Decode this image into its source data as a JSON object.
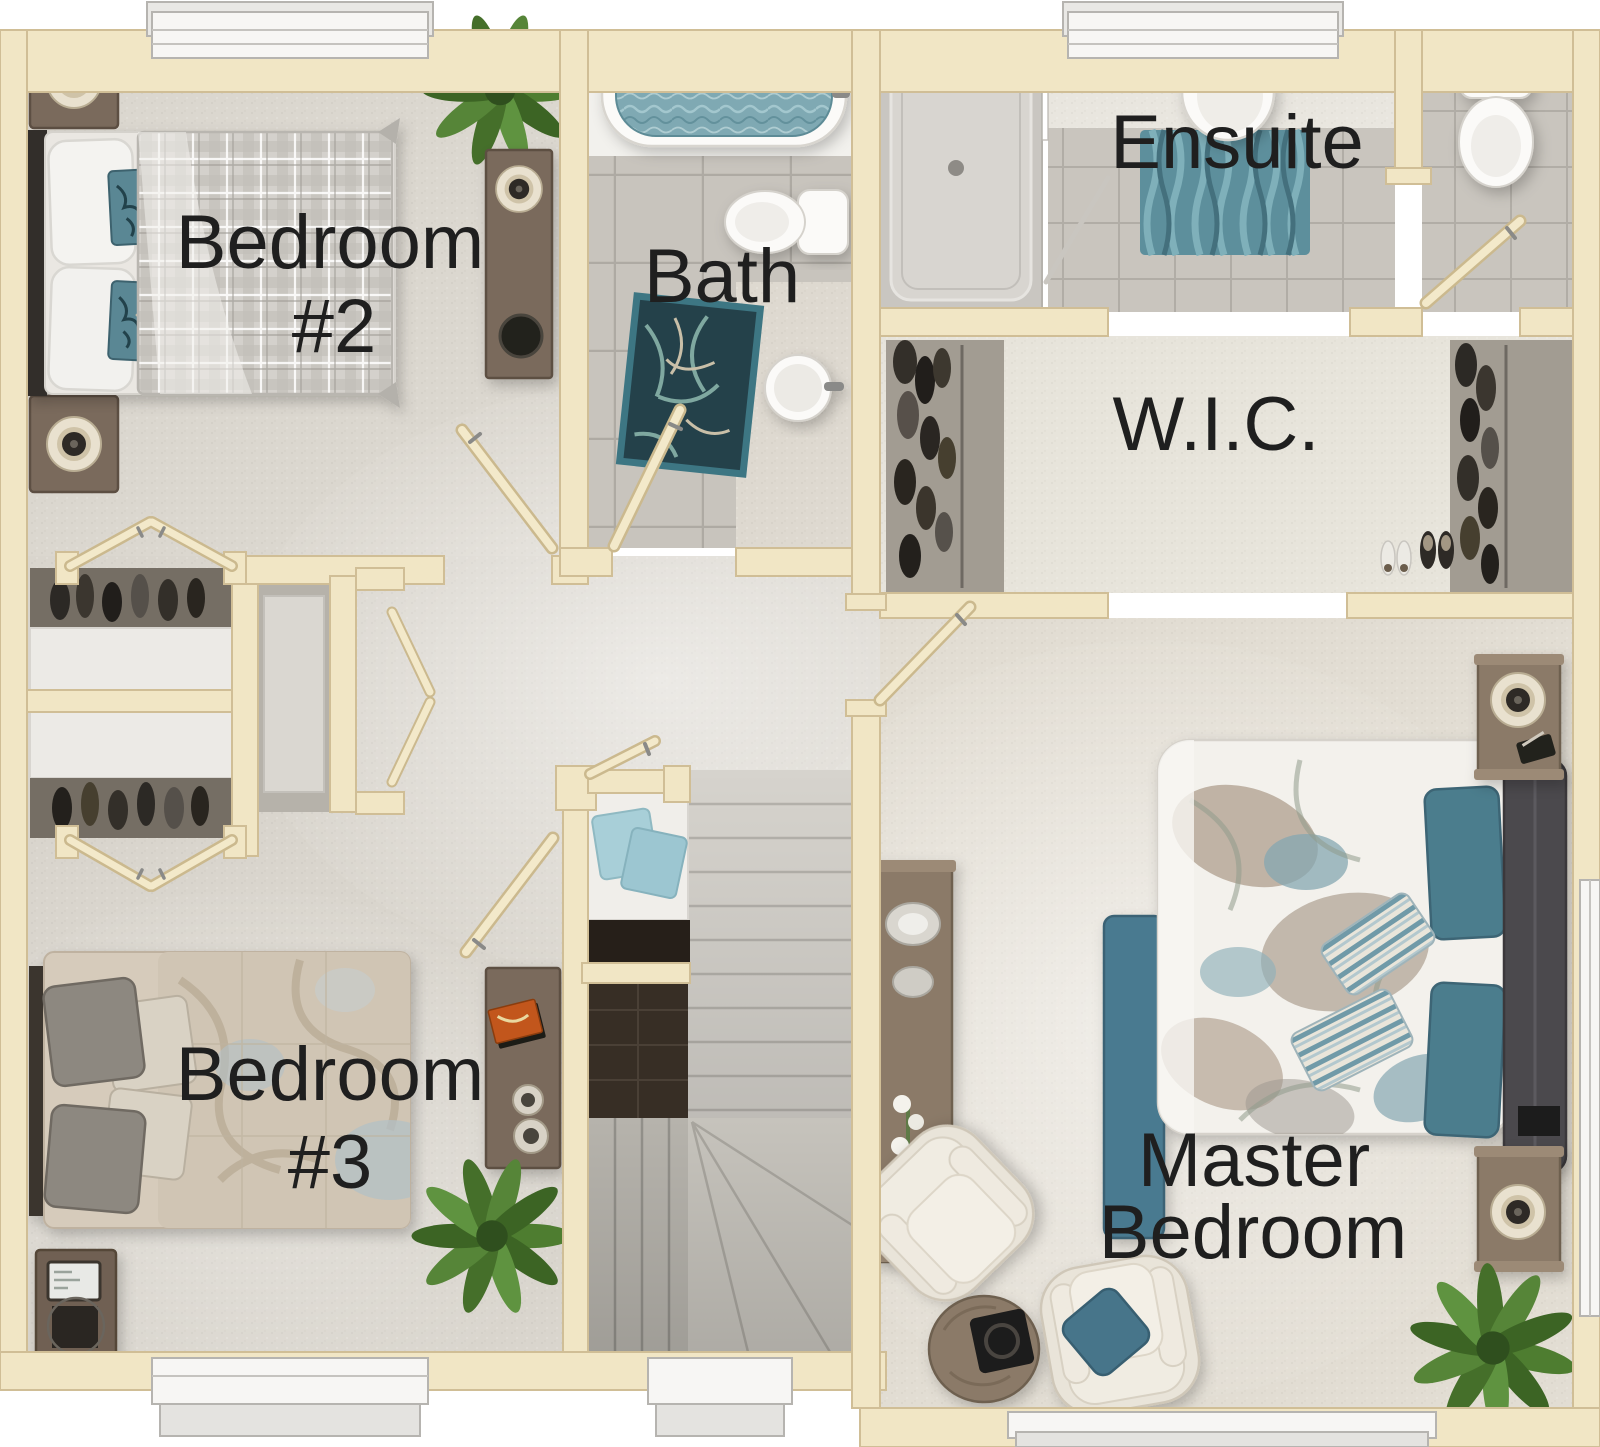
{
  "plan": {
    "type": "residential-second-floor-plan",
    "rooms": {
      "bedroom2": {
        "line1": "Bedroom",
        "line2": "#2"
      },
      "bath": {
        "label": "Bath"
      },
      "ensuite": {
        "label": "Ensuite"
      },
      "wic": {
        "label": "W.I.C."
      },
      "bedroom3": {
        "line1": "Bedroom",
        "line2": "#3"
      },
      "master": {
        "line1": "Master",
        "line2": "Bedroom"
      }
    },
    "palette": {
      "wall": "#f1e6c5",
      "wall_edge": "#d0be96",
      "carpet": "#dbd7cf",
      "carpet_master": "#e2ddd3",
      "carpet_wic": "#e7e4db",
      "tile_bath": "#c8c4bd",
      "tile_grout": "#aeaaa3",
      "tub_water": "#7fa9b3",
      "accent_teal": "#4a7c8c",
      "wood": "#8b7a68",
      "wood_dark": "#6e6050",
      "label_text": "#1f1f1f",
      "fixture_white": "#fbfaf8",
      "plant_green": "#4e7d30"
    }
  }
}
